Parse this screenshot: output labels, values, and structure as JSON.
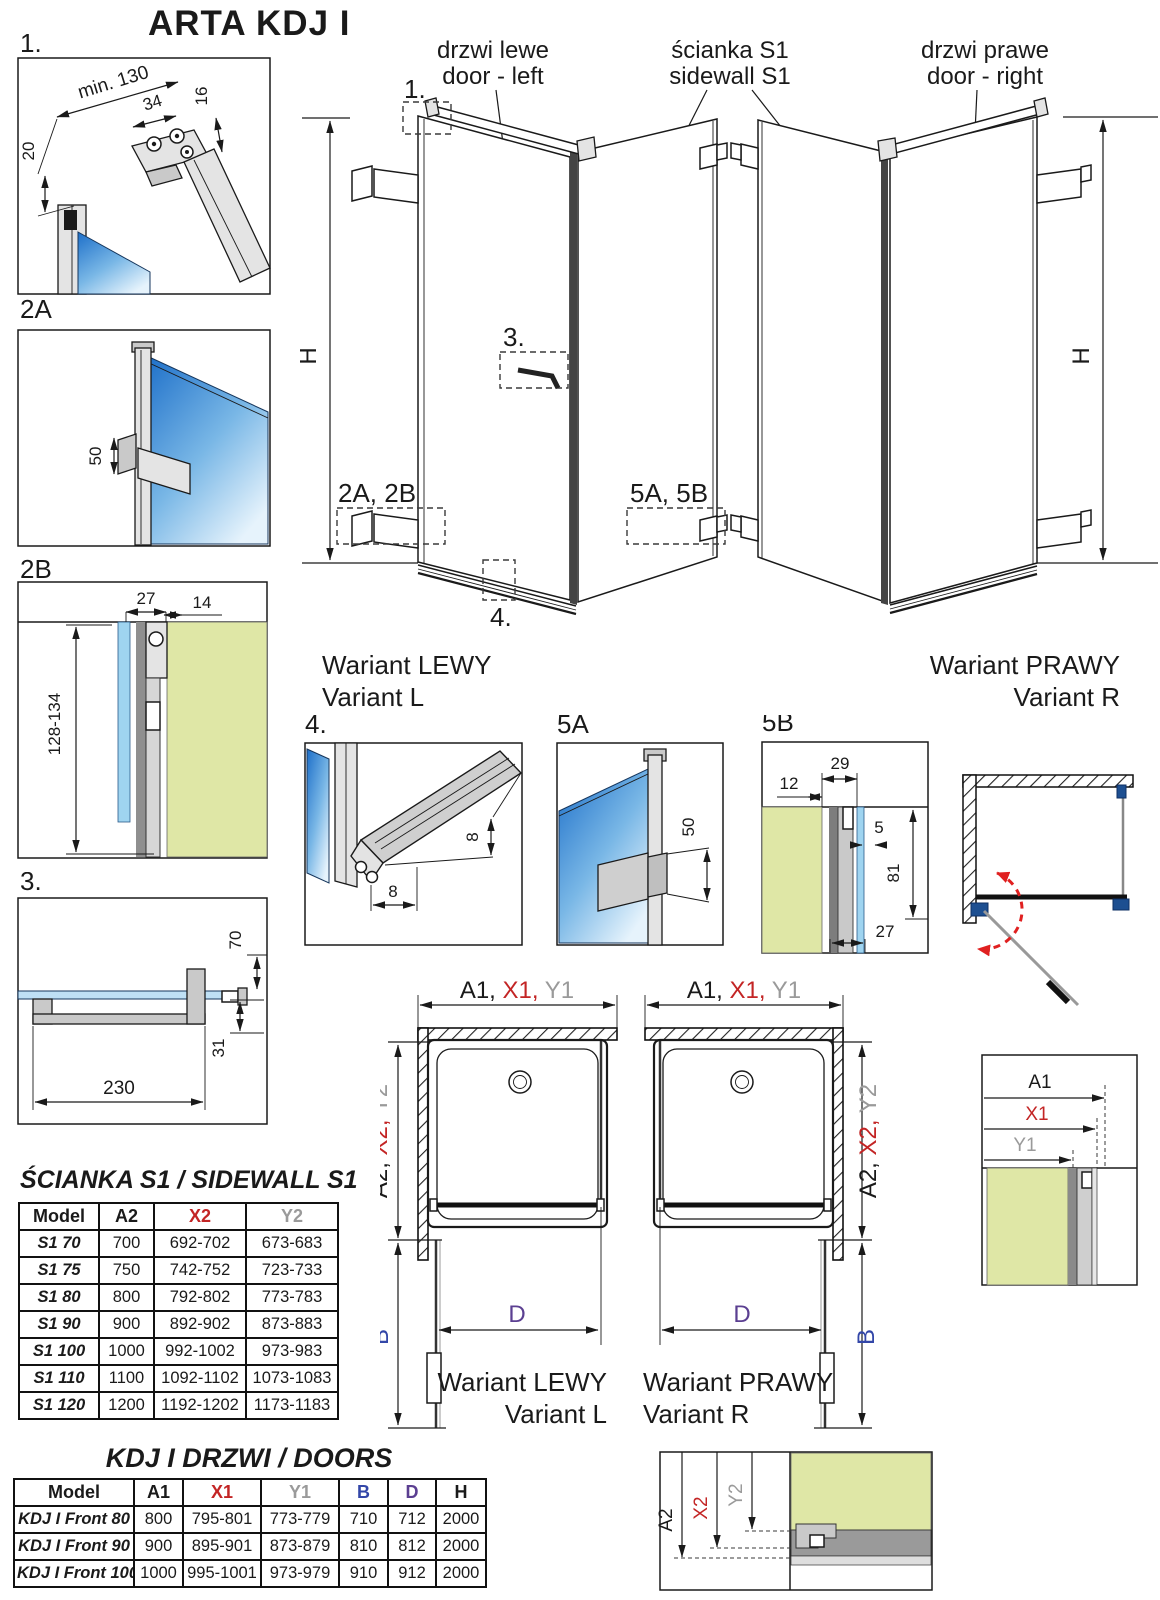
{
  "title": "ARTA KDJ I",
  "main": {
    "door_left": {
      "pl": "drzwi lewe",
      "en": "door - left"
    },
    "sidewall": {
      "pl": "ścianka S1",
      "en": "sidewall S1"
    },
    "door_right": {
      "pl": "drzwi prawe",
      "en": "door - right"
    },
    "h_label": "H",
    "variant_left": {
      "pl": "Wariant LEWY",
      "en": "Variant L"
    },
    "variant_right": {
      "pl": "Wariant PRAWY",
      "en": "Variant R"
    },
    "callouts": {
      "c1": "1.",
      "c3": "3.",
      "c4": "4.",
      "c2ab": "2A, 2B",
      "c5ab": "5A, 5B"
    }
  },
  "details": {
    "d1": {
      "label": "1.",
      "dim_min": "min. 130",
      "dim_34": "34",
      "dim_16": "16",
      "dim_20": "20"
    },
    "d2a": {
      "label": "2A",
      "dim_50": "50"
    },
    "d2b": {
      "label": "2B",
      "dim_27": "27",
      "dim_14": "14",
      "dim_range": "128-134"
    },
    "d3": {
      "label": "3.",
      "dim_70": "70",
      "dim_31": "31",
      "dim_230": "230"
    },
    "d4": {
      "label": "4.",
      "dim_h": "8",
      "dim_w": "8"
    },
    "d5a": {
      "label": "5A",
      "dim_50": "50"
    },
    "d5b": {
      "label": "5B",
      "dim_12": "12",
      "dim_29": "29",
      "dim_5": "5",
      "dim_81": "81",
      "dim_27": "27"
    }
  },
  "plans": {
    "top_a": "A1, ",
    "top_x": "X1, ",
    "top_y": "Y1",
    "side_a": "A2, ",
    "side_x": "X2, ",
    "side_y": "Y2",
    "b": "B",
    "d": "D"
  },
  "corner1": {
    "a": "A1",
    "x": "X1",
    "y": "Y1"
  },
  "corner2": {
    "a": "A2",
    "x": "X2",
    "y": "Y2"
  },
  "sidewall_table": {
    "title": "ŚCIANKA S1 / SIDEWALL S1",
    "headers": [
      "Model",
      "A2",
      "X2",
      "Y2"
    ],
    "rows": [
      [
        "S1 70",
        "700",
        "692-702",
        "673-683"
      ],
      [
        "S1 75",
        "750",
        "742-752",
        "723-733"
      ],
      [
        "S1 80",
        "800",
        "792-802",
        "773-783"
      ],
      [
        "S1 90",
        "900",
        "892-902",
        "873-883"
      ],
      [
        "S1 100",
        "1000",
        "992-1002",
        "973-983"
      ],
      [
        "S1 110",
        "1100",
        "1092-1102",
        "1073-1083"
      ],
      [
        "S1 120",
        "1200",
        "1192-1202",
        "1173-1183"
      ]
    ]
  },
  "doors_table": {
    "title": "KDJ I DRZWI / DOORS",
    "headers": [
      "Model",
      "A1",
      "X1",
      "Y1",
      "B",
      "D",
      "H"
    ],
    "rows": [
      [
        "KDJ I Front 80",
        "800",
        "795-801",
        "773-779",
        "710",
        "712",
        "2000"
      ],
      [
        "KDJ I Front 90",
        "900",
        "895-901",
        "873-879",
        "810",
        "812",
        "2000"
      ],
      [
        "KDJ I Front 100",
        "1000",
        "995-1001",
        "973-979",
        "910",
        "912",
        "2000"
      ]
    ]
  },
  "colors": {
    "accent_red": "#c32525",
    "dim_gray": "#9a9a9a",
    "dim_blue": "#3347a8",
    "dim_purple": "#5b3f91",
    "glass_blue": "#1d6fc9",
    "wall_green": "#dfe7a6",
    "swing_red": "#e02020",
    "hinge_blue": "#1d4f91"
  }
}
